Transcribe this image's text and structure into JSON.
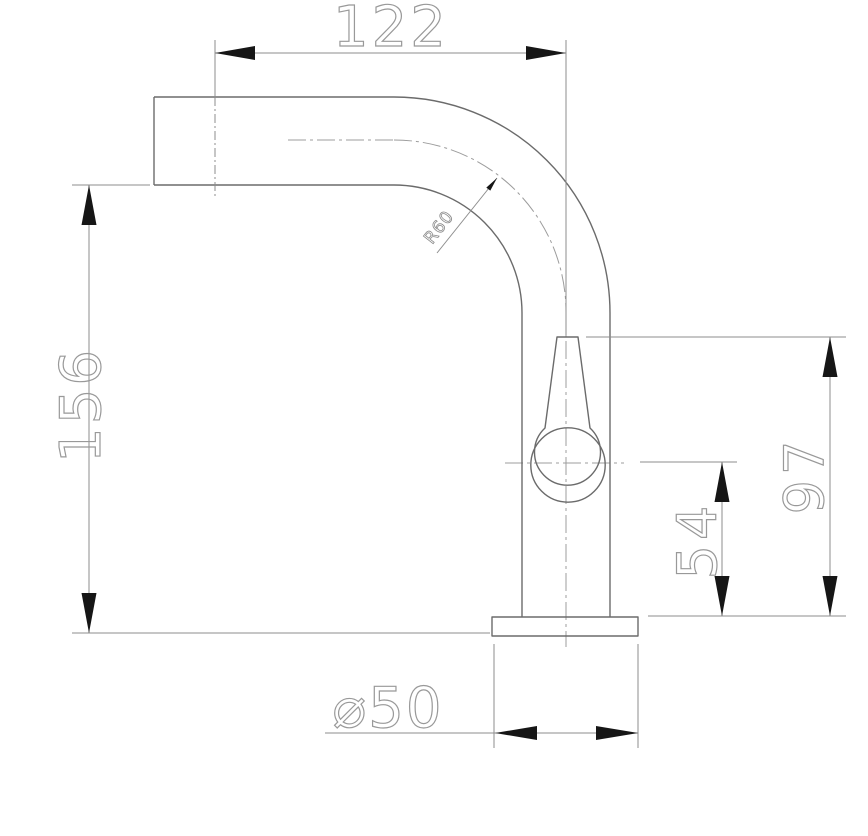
{
  "drawing": {
    "kind": "faucet-technical-drawing-side-elevation"
  },
  "colors": {
    "background": "#ffffff",
    "body_outline": "#6b6b6b",
    "dimension_line": "#8d8d8d",
    "centerline": "#9c9c9c",
    "arrow_fill": "#161616",
    "dimension_text": "#999999",
    "radius_text": "#8a8a8a"
  },
  "dimensions": {
    "spout_reach": "122",
    "overall_height": "156",
    "handle_top_height": "97",
    "handle_center_height": "54",
    "bend_radius": "R60",
    "base_diameter": "⌀50"
  }
}
